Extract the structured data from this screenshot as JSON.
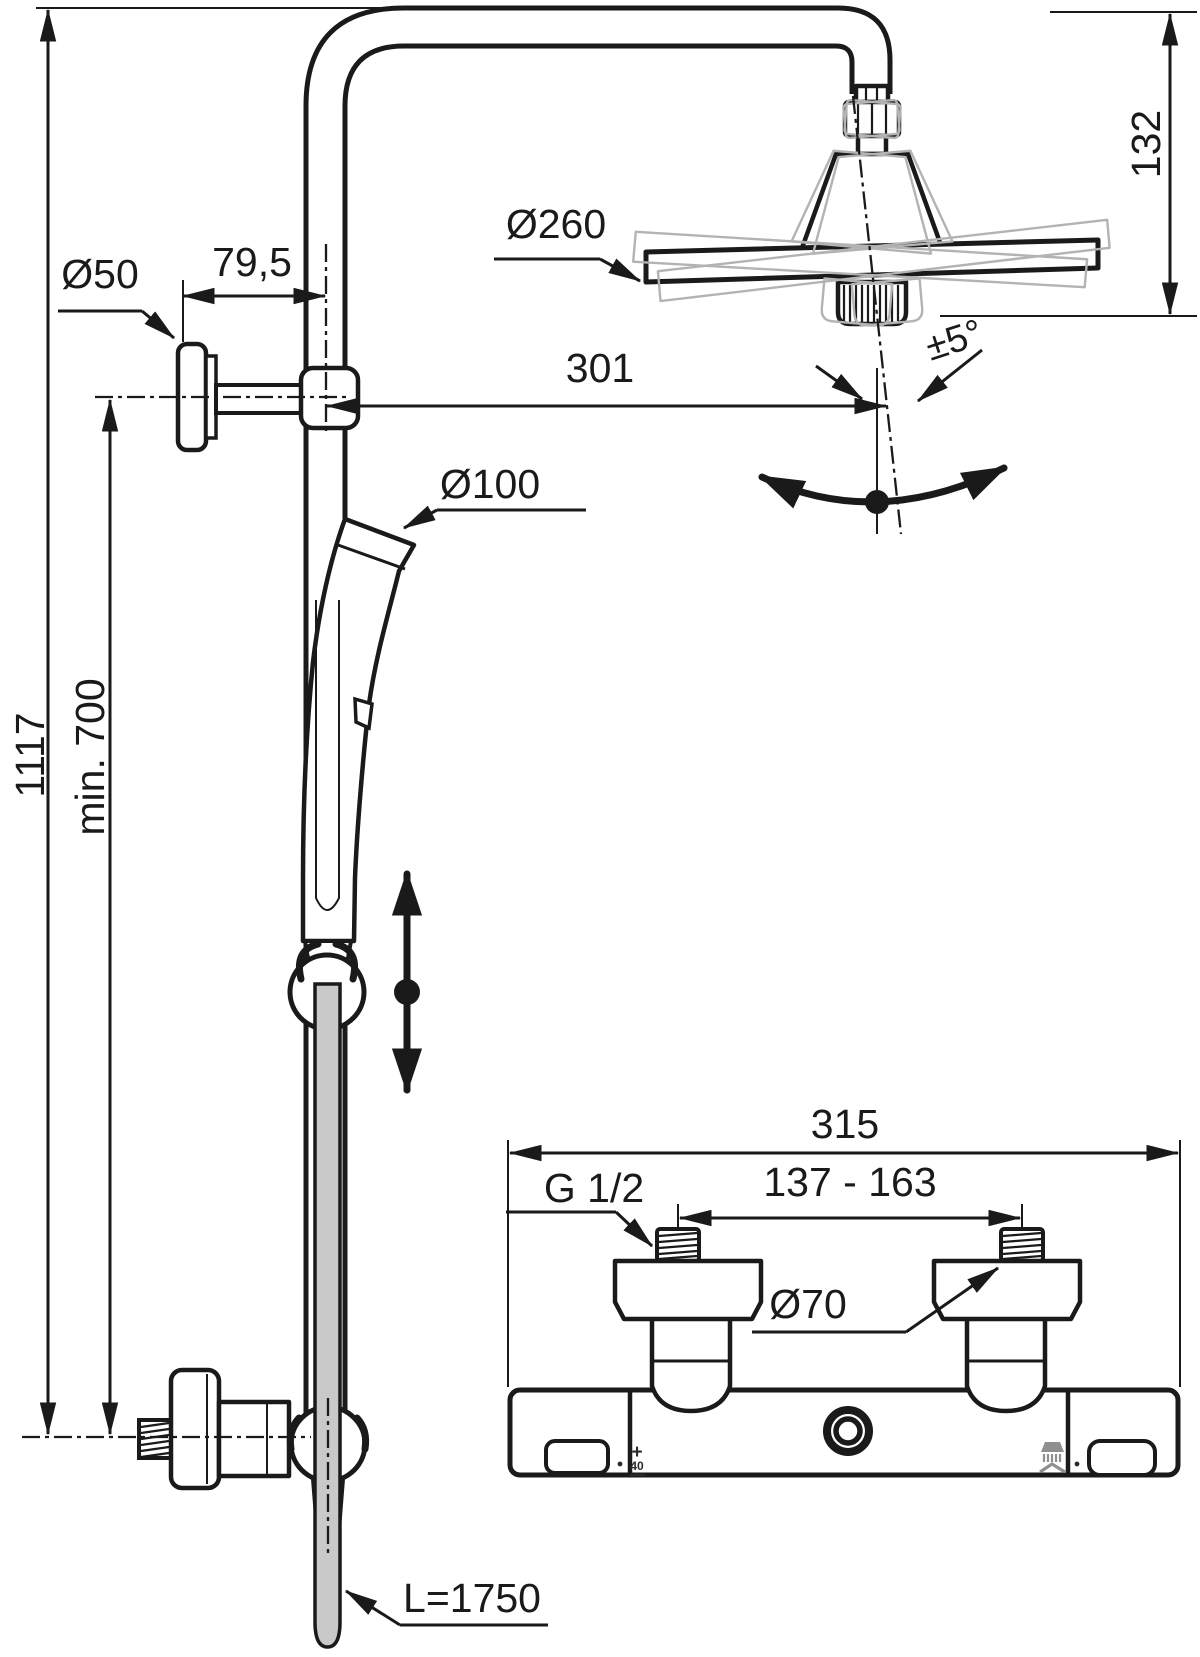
{
  "diagram": {
    "title": "Shower system installation drawing",
    "type": "technical-dimension-drawing",
    "line_color": "#1a1a1a",
    "ghost_color": "#b3b3b3",
    "hose_color": "#c9c9c9",
    "icon_gray": "#8f8f8f"
  },
  "dimensions": {
    "overall_height": "1117",
    "min_mounting_height": "min. 700",
    "wall_bracket_offset": "79,5",
    "wall_bracket_diameter": "Ø50",
    "rain_head_diameter": "Ø260",
    "head_drop_height": "132",
    "head_reach": "301",
    "head_tilt_angle": "±5°",
    "hand_shower_diameter": "Ø100",
    "mixer_overall_width": "315",
    "inlet_spacing": "137 - 163",
    "inlet_thread": "G 1/2",
    "mixer_body_diameter": "Ø70",
    "hose_length": "L=1750"
  },
  "mixer_markings": {
    "temp_plus": "+",
    "temp_value": "40"
  }
}
